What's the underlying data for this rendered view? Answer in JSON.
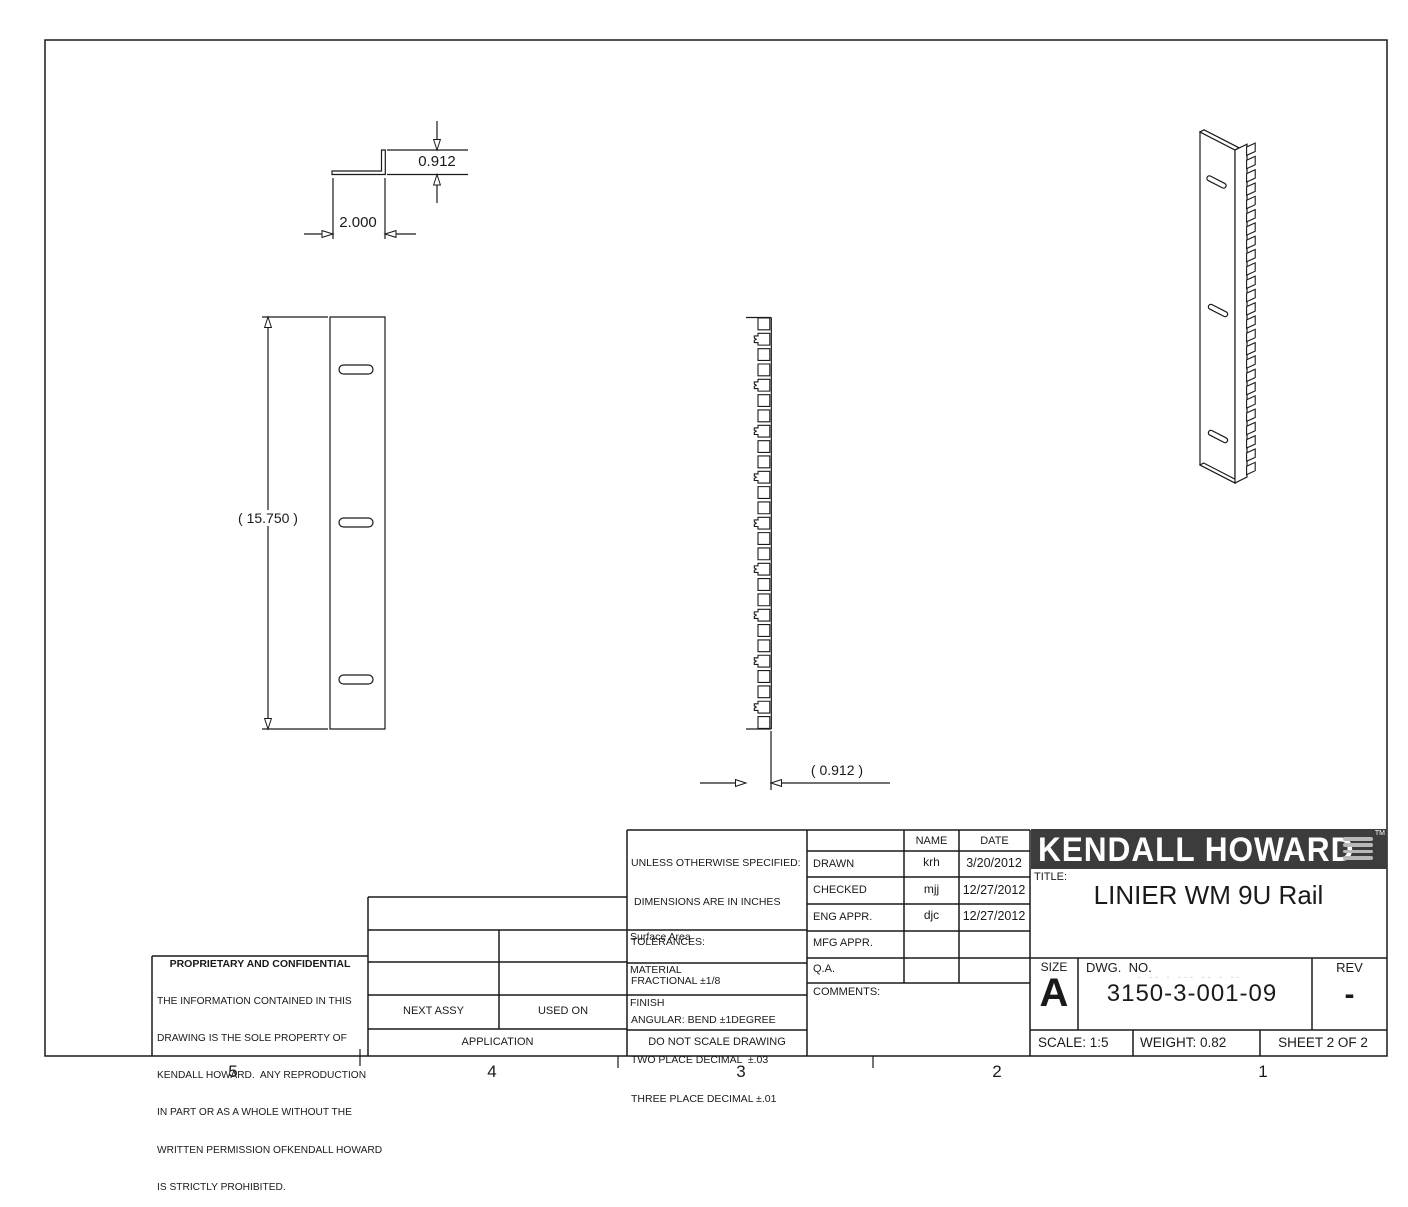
{
  "sheet": {
    "zone_labels": [
      "5",
      "4",
      "3",
      "2",
      "1"
    ]
  },
  "dimensions": {
    "top_view_lip_height": "0.912",
    "top_view_flange_width": "2.000",
    "front_view_overall_length": "( 15.750 )",
    "side_view_flange_width": "( 0.912 )"
  },
  "views": {
    "front_view": {
      "slot_count": 3
    },
    "side_view": {
      "square_hole_count": 27
    },
    "isometric": {
      "tooth_count": 25
    }
  },
  "title_block": {
    "tolerance_lines": [
      "UNLESS OTHERWISE SPECIFIED:",
      "DIMENSIONS ARE IN INCHES",
      "TOLERANCES:",
      "FRACTIONAL ±1/8",
      "ANGULAR: BEND ±1DEGREE",
      "TWO PLACE DECIMAL  ±.03",
      "THREE PLACE DECIMAL ±.01"
    ],
    "surface_area_label": "Surface Area",
    "material_label": "MATERIAL",
    "finish_label": "FINISH",
    "do_not_scale": "DO NOT SCALE DRAWING",
    "approvals": {
      "name_header": "NAME",
      "date_header": "DATE",
      "rows": [
        {
          "label": "DRAWN",
          "name": "krh",
          "date": "3/20/2012"
        },
        {
          "label": "CHECKED",
          "name": "mjj",
          "date": "12/27/2012"
        },
        {
          "label": "ENG APPR.",
          "name": "djc",
          "date": "12/27/2012"
        },
        {
          "label": "MFG APPR.",
          "name": "",
          "date": ""
        },
        {
          "label": "Q.A.",
          "name": "",
          "date": ""
        }
      ],
      "comments_label": "COMMENTS:"
    },
    "proprietary": {
      "heading": "PROPRIETARY AND CONFIDENTIAL",
      "lines": [
        "THE INFORMATION CONTAINED IN THIS",
        "DRAWING IS THE SOLE PROPERTY OF",
        "KENDALL HOWARD.  ANY REPRODUCTION",
        "IN PART OR AS A WHOLE WITHOUT THE",
        "WRITTEN PERMISSION OFKENDALL HOWARD",
        "IS STRICTLY PROHIBITED."
      ]
    },
    "application": {
      "next_assy": "NEXT ASSY",
      "used_on": "USED ON",
      "application": "APPLICATION"
    },
    "brand": {
      "logo_text": "KENDALL HOWARD",
      "tm": "TM"
    },
    "title_label": "TITLE:",
    "title": "LINIER WM 9U Rail",
    "size_label": "SIZE",
    "size": "A",
    "dwg_label": "DWG.  NO.",
    "dwg_ghost": "- -- - --- -- - --",
    "dwg_no": "3150-3-001-09",
    "rev_label": "REV",
    "rev": "-",
    "scale": "SCALE: 1:5",
    "weight": "WEIGHT: 0.82",
    "sheet": "SHEET 2 OF 2"
  },
  "colors": {
    "line": "#1a1a1a",
    "logo_bg": "#3c3c3c",
    "logo_bars": "#b8b8b8",
    "ghost_text": "#c9c9c9"
  }
}
